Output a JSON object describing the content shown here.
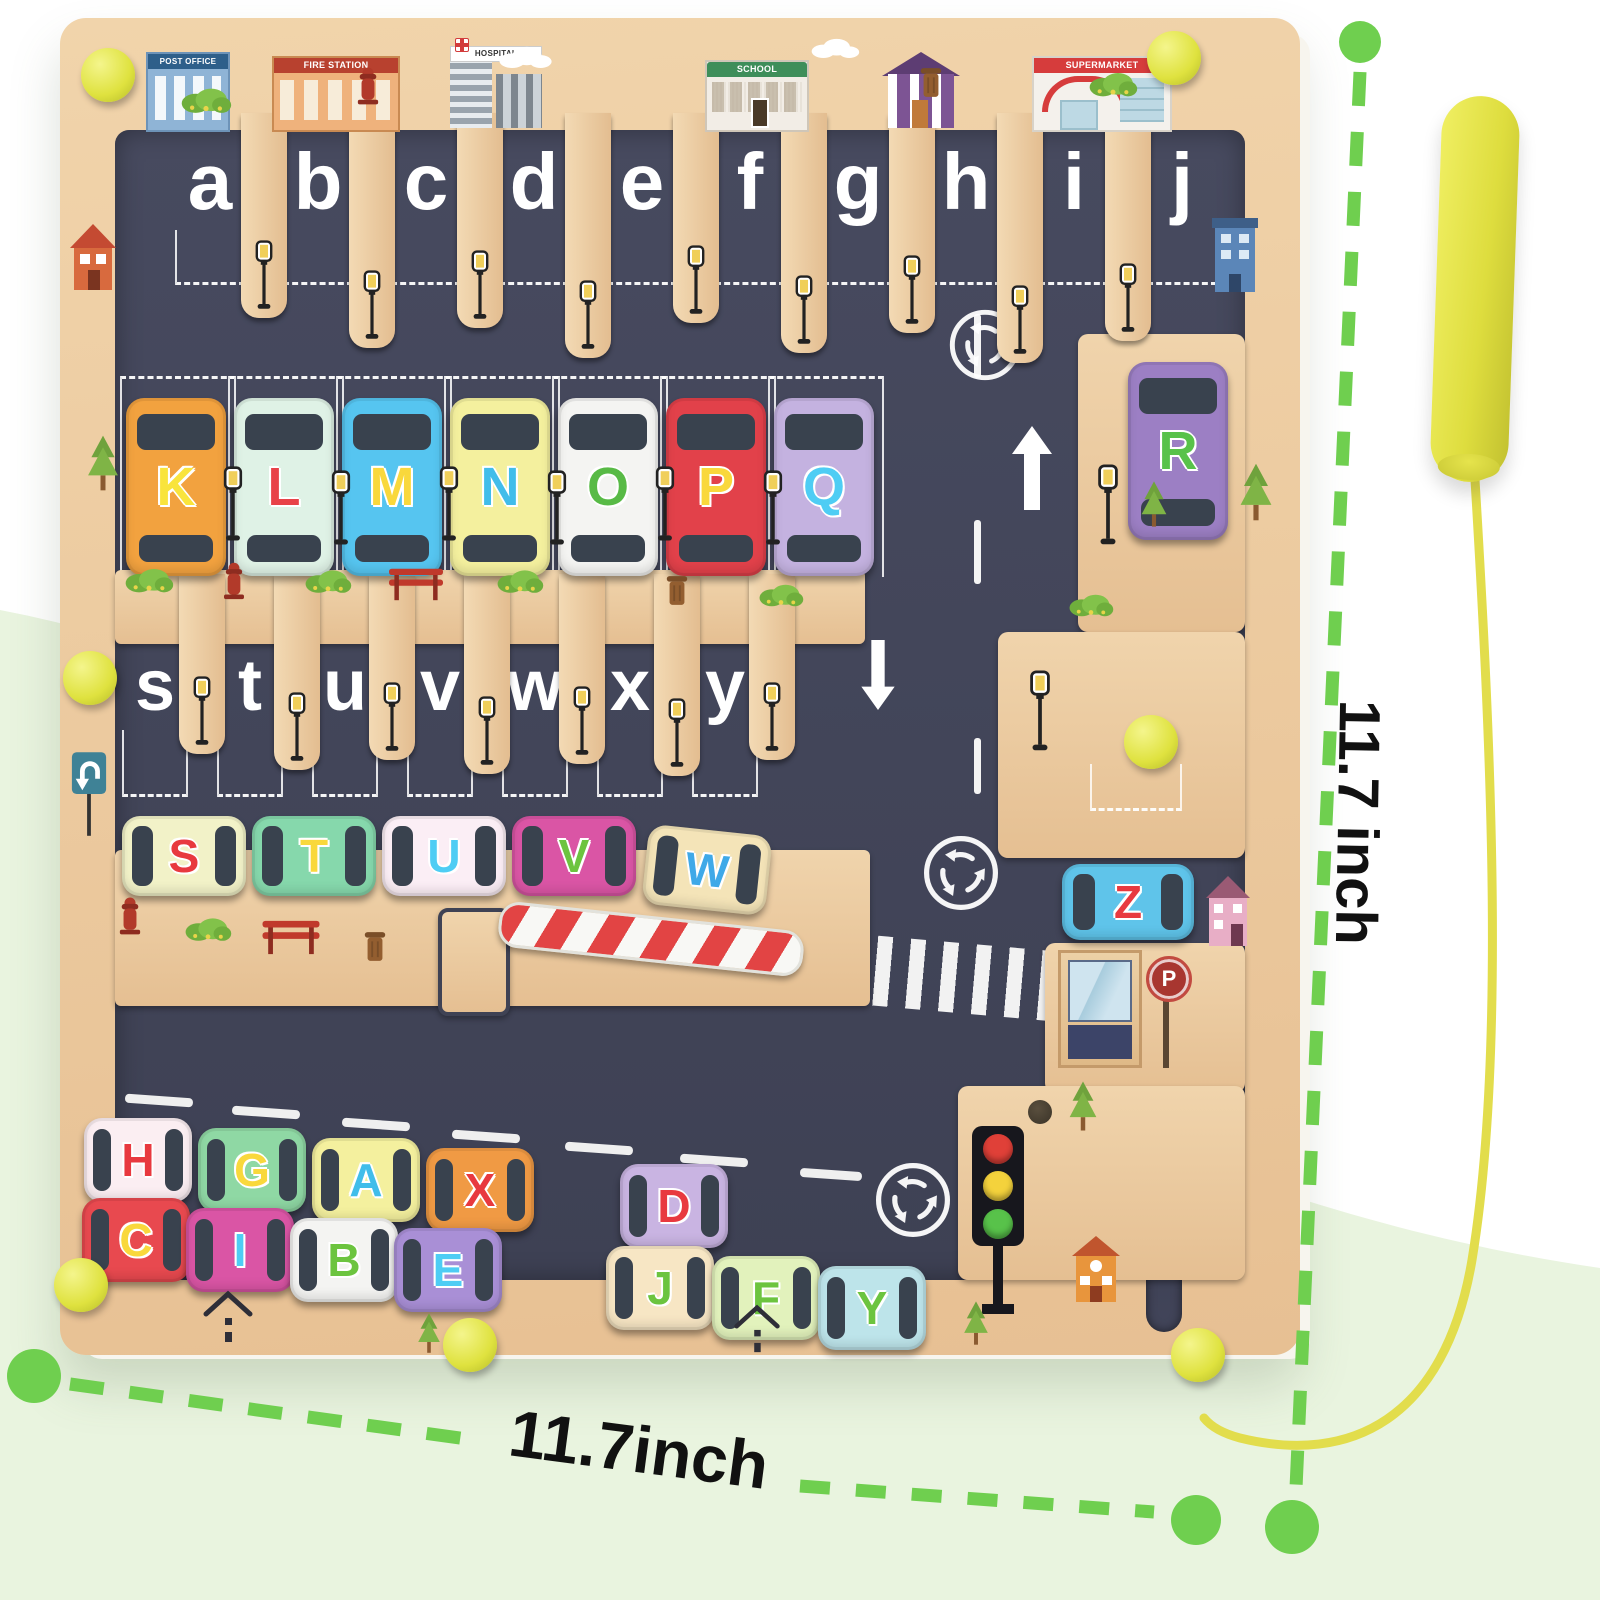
{
  "annotations": {
    "width_label": "11.7inch",
    "height_label": "11.7 inch",
    "line_color": "#6fcf4f",
    "text_color": "#111111"
  },
  "palette": {
    "wood": "#ecc99f",
    "maze_dark": "#42455a",
    "knob_yellow": "#dfe23f",
    "pen_yellow": "#dedd3e",
    "backdrop_green": "#e9f4df"
  },
  "buildings": {
    "post_office": "POST OFFICE",
    "fire_station": "FIRE STATION",
    "hospital": "HOSPITAL",
    "school": "SCHOOL",
    "supermarket": "SUPERMARKET"
  },
  "signs": {
    "parking_letter": "P"
  },
  "letters": {
    "top": [
      {
        "ch": "a",
        "x": 150
      },
      {
        "ch": "b",
        "x": 258
      },
      {
        "ch": "c",
        "x": 366
      },
      {
        "ch": "d",
        "x": 474
      },
      {
        "ch": "e",
        "x": 582
      },
      {
        "ch": "f",
        "x": 690
      },
      {
        "ch": "g",
        "x": 798
      },
      {
        "ch": "h",
        "x": 906
      },
      {
        "ch": "i",
        "x": 1014
      },
      {
        "ch": "j",
        "x": 1122
      }
    ],
    "mid": [
      {
        "ch": "s",
        "x": 95
      },
      {
        "ch": "t",
        "x": 190
      },
      {
        "ch": "u",
        "x": 285
      },
      {
        "ch": "v",
        "x": 380
      },
      {
        "ch": "w",
        "x": 475
      },
      {
        "ch": "x",
        "x": 570
      },
      {
        "ch": "y",
        "x": 665
      }
    ],
    "z": {
      "ch": "z",
      "x": 1074
    }
  },
  "slats": {
    "top": [
      {
        "x": 204,
        "h": 205
      },
      {
        "x": 312,
        "h": 235
      },
      {
        "x": 420,
        "h": 215
      },
      {
        "x": 528,
        "h": 245
      },
      {
        "x": 636,
        "h": 210
      },
      {
        "x": 744,
        "h": 240
      },
      {
        "x": 852,
        "h": 220
      },
      {
        "x": 960,
        "h": 250
      },
      {
        "x": 1068,
        "h": 228
      }
    ],
    "mid": [
      {
        "x": 142,
        "h": 180
      },
      {
        "x": 237,
        "h": 196
      },
      {
        "x": 332,
        "h": 186
      },
      {
        "x": 427,
        "h": 200
      },
      {
        "x": 522,
        "h": 190
      },
      {
        "x": 617,
        "h": 202
      },
      {
        "x": 712,
        "h": 186
      }
    ]
  },
  "cars": {
    "parked": [
      {
        "letter": "K",
        "x": 66,
        "y": 380,
        "body": "#f2a23f",
        "lc": "#f9e43c"
      },
      {
        "letter": "L",
        "x": 174,
        "y": 380,
        "body": "#dff2e6",
        "lc": "#e84248"
      },
      {
        "letter": "M",
        "x": 282,
        "y": 380,
        "body": "#56c5f0",
        "lc": "#f9d83c"
      },
      {
        "letter": "N",
        "x": 390,
        "y": 380,
        "body": "#f4f09e",
        "lc": "#41bdea"
      },
      {
        "letter": "O",
        "x": 498,
        "y": 380,
        "body": "#f4f4f2",
        "lc": "#58ba46"
      },
      {
        "letter": "P",
        "x": 606,
        "y": 380,
        "body": "#e2414a",
        "lc": "#f9d83c"
      },
      {
        "letter": "Q",
        "x": 714,
        "y": 380,
        "body": "#c4b2e0",
        "lc": "#4ecdf4"
      }
    ],
    "r": [
      {
        "letter": "R",
        "x": 1068,
        "y": 344,
        "body": "#9c7fc4",
        "lc": "#58c24a"
      }
    ],
    "mid": [
      {
        "letter": "S",
        "x": 62,
        "y": 798,
        "body": "#f2f2c8",
        "lc": "#e8393f"
      },
      {
        "letter": "T",
        "x": 192,
        "y": 798,
        "body": "#86d8ac",
        "lc": "#f9d83c"
      },
      {
        "letter": "U",
        "x": 322,
        "y": 798,
        "body": "#fbeef5",
        "lc": "#4ecdf4"
      },
      {
        "letter": "V",
        "x": 452,
        "y": 798,
        "body": "#da55a5",
        "lc": "#6cc43f"
      },
      {
        "letter": "W",
        "x": 585,
        "y": 812,
        "body": "#f4e4b8",
        "lc": "#3fa9e8",
        "rot": "rotate(6deg)"
      }
    ],
    "z": [
      {
        "letter": "Z",
        "x": 1002,
        "y": 846,
        "w": 132,
        "h": 76,
        "body": "#5fc4ea",
        "lc": "#e8393f"
      }
    ],
    "jam_upper": [
      {
        "letter": "H",
        "x": 24,
        "y": 1100,
        "body": "#fbeef2",
        "lc": "#e8393f"
      },
      {
        "letter": "G",
        "x": 138,
        "y": 1110,
        "body": "#8fd8a4",
        "lc": "#f9d83c"
      },
      {
        "letter": "A",
        "x": 252,
        "y": 1120,
        "body": "#f4f09e",
        "lc": "#41bdea"
      },
      {
        "letter": "X",
        "x": 366,
        "y": 1130,
        "body": "#f09a44",
        "lc": "#e8393f"
      },
      {
        "letter": "D",
        "x": 560,
        "y": 1146,
        "body": "#c9b4e2",
        "lc": "#e8393f"
      }
    ],
    "jam_lower": [
      {
        "letter": "C",
        "x": 22,
        "y": 1180,
        "body": "#e8494f",
        "lc": "#f9d83c"
      },
      {
        "letter": "I",
        "x": 126,
        "y": 1190,
        "body": "#da55a5",
        "lc": "#4ecdf4"
      },
      {
        "letter": "B",
        "x": 230,
        "y": 1200,
        "body": "#f4f4f2",
        "lc": "#6cc43f"
      },
      {
        "letter": "E",
        "x": 334,
        "y": 1210,
        "body": "#a98fd6",
        "lc": "#4ecdf4"
      },
      {
        "letter": "J",
        "x": 546,
        "y": 1228,
        "body": "#f7e6c4",
        "lc": "#6cc43f"
      },
      {
        "letter": "F",
        "x": 652,
        "y": 1238,
        "body": "#e2f2bc",
        "lc": "#6cc43f"
      },
      {
        "letter": "Y",
        "x": 758,
        "y": 1248,
        "body": "#bde4ea",
        "lc": "#6cc43f"
      }
    ]
  },
  "traffic_light": {
    "lights": [
      {
        "c": "#e04038"
      },
      {
        "c": "#f4d23c"
      },
      {
        "c": "#58c24a"
      }
    ]
  },
  "roundabouts": [
    {
      "x": 887,
      "y": 289,
      "s": 76
    },
    {
      "x": 861,
      "y": 815,
      "s": 80
    },
    {
      "x": 813,
      "y": 1142,
      "s": 80
    }
  ],
  "knobs": [
    {
      "x": 21,
      "y": 30
    },
    {
      "x": 1087,
      "y": 13
    },
    {
      "x": 3,
      "y": 633
    },
    {
      "x": 1064,
      "y": 697
    },
    {
      "x": -6,
      "y": 1240
    },
    {
      "x": 383,
      "y": 1300
    },
    {
      "x": 1111,
      "y": 1310
    }
  ],
  "road_dashes": [
    {
      "x": 914,
      "y": 296,
      "h": 64
    },
    {
      "x": 914,
      "y": 502,
      "h": 64
    },
    {
      "x": 914,
      "y": 720,
      "h": 56
    }
  ],
  "lane_dashes": [
    {
      "x": 65,
      "y": 1078,
      "w": 68
    },
    {
      "x": 172,
      "y": 1090,
      "w": 68
    },
    {
      "x": 282,
      "y": 1102,
      "w": 68
    },
    {
      "x": 392,
      "y": 1114,
      "w": 68
    },
    {
      "x": 505,
      "y": 1126,
      "w": 68
    },
    {
      "x": 620,
      "y": 1138,
      "w": 68
    },
    {
      "x": 740,
      "y": 1152,
      "w": 62
    }
  ],
  "decorations": [
    {
      "type": "bush",
      "x": 120,
      "y": 66,
      "w": 52,
      "h": 30
    },
    {
      "type": "hydrant",
      "x": 296,
      "y": 46,
      "w": 24,
      "h": 42
    },
    {
      "type": "cloud",
      "x": 436,
      "y": 28,
      "w": 58,
      "h": 22
    },
    {
      "type": "cloud",
      "x": 748,
      "y": 20,
      "w": 54,
      "h": 20
    },
    {
      "type": "trash",
      "x": 858,
      "y": 46,
      "w": 26,
      "h": 36
    },
    {
      "type": "bush",
      "x": 1028,
      "y": 50,
      "w": 50,
      "h": 30
    },
    {
      "type": "house-red",
      "x": 8,
      "y": 204,
      "w": 50,
      "h": 72
    },
    {
      "type": "tree",
      "x": 26,
      "y": 416,
      "w": 34,
      "h": 58
    },
    {
      "type": "uturn",
      "x": 10,
      "y": 732,
      "w": 38,
      "h": 88
    },
    {
      "type": "house-blue",
      "x": 1150,
      "y": 198,
      "w": 50,
      "h": 80
    },
    {
      "type": "tree",
      "x": 1178,
      "y": 444,
      "w": 36,
      "h": 60
    },
    {
      "type": "tree",
      "x": 1080,
      "y": 462,
      "w": 28,
      "h": 48
    },
    {
      "type": "bush",
      "x": 64,
      "y": 546,
      "w": 50,
      "h": 30
    },
    {
      "type": "hydrant",
      "x": 162,
      "y": 542,
      "w": 24,
      "h": 40
    },
    {
      "type": "bush",
      "x": 244,
      "y": 548,
      "w": 48,
      "h": 28
    },
    {
      "type": "bench",
      "x": 326,
      "y": 548,
      "w": 60,
      "h": 36
    },
    {
      "type": "bush",
      "x": 436,
      "y": 548,
      "w": 48,
      "h": 28
    },
    {
      "type": "trash",
      "x": 604,
      "y": 554,
      "w": 26,
      "h": 36
    },
    {
      "type": "bush",
      "x": 698,
      "y": 562,
      "w": 46,
      "h": 28
    },
    {
      "type": "bush",
      "x": 1008,
      "y": 572,
      "w": 46,
      "h": 28
    },
    {
      "type": "hydrant",
      "x": 58,
      "y": 876,
      "w": 24,
      "h": 42
    },
    {
      "type": "bush",
      "x": 124,
      "y": 896,
      "w": 48,
      "h": 28
    },
    {
      "type": "bench",
      "x": 200,
      "y": 900,
      "w": 62,
      "h": 38
    },
    {
      "type": "trash",
      "x": 302,
      "y": 910,
      "w": 26,
      "h": 36
    },
    {
      "type": "house-pink",
      "x": 1144,
      "y": 856,
      "w": 48,
      "h": 76
    },
    {
      "type": "tree",
      "x": 1008,
      "y": 1062,
      "w": 30,
      "h": 52
    },
    {
      "type": "house-orange",
      "x": 1010,
      "y": 1216,
      "w": 52,
      "h": 72
    },
    {
      "type": "tree",
      "x": 902,
      "y": 1282,
      "w": 28,
      "h": 46
    },
    {
      "type": "house-outline",
      "x": 142,
      "y": 1272,
      "w": 52,
      "h": 54
    },
    {
      "type": "tree",
      "x": 356,
      "y": 1294,
      "w": 26,
      "h": 42
    },
    {
      "type": "house-outline",
      "x": 672,
      "y": 1286,
      "w": 50,
      "h": 50
    },
    {
      "type": "lamppost",
      "x": 160,
      "y": 448,
      "w": 26,
      "h": 78
    },
    {
      "type": "lamppost",
      "x": 268,
      "y": 452,
      "w": 26,
      "h": 78
    },
    {
      "type": "lamppost",
      "x": 376,
      "y": 448,
      "w": 26,
      "h": 78
    },
    {
      "type": "lamppost",
      "x": 484,
      "y": 452,
      "w": 26,
      "h": 78
    },
    {
      "type": "lamppost",
      "x": 592,
      "y": 448,
      "w": 26,
      "h": 78
    },
    {
      "type": "lamppost",
      "x": 700,
      "y": 452,
      "w": 26,
      "h": 78
    },
    {
      "type": "lamppost",
      "x": 1034,
      "y": 446,
      "w": 28,
      "h": 84
    },
    {
      "type": "lamppost",
      "x": 966,
      "y": 652,
      "w": 28,
      "h": 84
    }
  ]
}
